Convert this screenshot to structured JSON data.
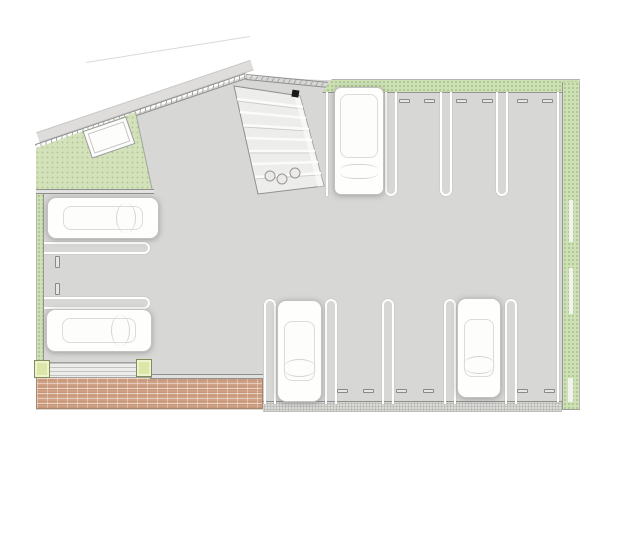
{
  "document": {
    "kind": "architectural site plan",
    "view": "top-down parking lot layout drawing",
    "visible_text": "none"
  },
  "legend_colors": {
    "pavement": "#d7d7d5",
    "landscaping_green": "#cde0b6",
    "brick_paving": "#cfa083",
    "gravel_edge": "#d9d9d6",
    "stall_marking": "#ffffff",
    "boundary_line": "#8f8f8f",
    "planter_post": "#dce6a8"
  },
  "parking_rows": [
    {
      "id": "top-row",
      "orientation": "vertical stalls entered from the south aisle",
      "stalls": 4,
      "occupied": 1,
      "wheel_stop_pairs": 3,
      "marking_style": "white hairpin loops rounded toward aisle"
    },
    {
      "id": "left-column",
      "orientation": "horizontal stalls entered from the east aisle",
      "stalls": 3,
      "occupied": 2,
      "wheel_stop_pairs": 1,
      "marking_style": "white hairpin loops rounded toward aisle"
    },
    {
      "id": "bottom-row",
      "orientation": "vertical stalls entered from the north aisle",
      "stalls": 5,
      "occupied": 2,
      "wheel_stop_pairs": 3,
      "marking_style": "white hairpin loops rounded toward aisle"
    }
  ],
  "vehicles": [
    {
      "id": "van-top-row",
      "type": "van",
      "color": "white"
    },
    {
      "id": "car-left-top",
      "type": "car",
      "color": "white"
    },
    {
      "id": "car-left-bottom",
      "type": "car",
      "color": "white"
    },
    {
      "id": "car-bottom-middle",
      "type": "car",
      "color": "white"
    },
    {
      "id": "car-bottom-right",
      "type": "car",
      "color": "white"
    }
  ],
  "site_features": [
    {
      "id": "diagonal-boundary-wall",
      "desc": "hatched double-line boundary wall along the northwest diagonal edge with parallel road band outside"
    },
    {
      "id": "landscape-wedge",
      "desc": "green planted wedge inside the northwest corner"
    },
    {
      "id": "small-shed",
      "desc": "small white flat-roofed structure sitting on the diagonal boundary"
    },
    {
      "id": "outbuilding-structure",
      "desc": "rotated striped enclosure with round containers beside the entrance drive"
    },
    {
      "id": "north-landscape-strip",
      "desc": "dotted planted strip along the north edge of the stalls"
    },
    {
      "id": "east-landscape-strip",
      "desc": "dotted planted strip along the east edge with small white path gaps"
    },
    {
      "id": "west-landscape-strip",
      "desc": "narrow planted strip along the west edge"
    },
    {
      "id": "brick-terrace",
      "desc": "brick-paved terrace across the southwest corner"
    },
    {
      "id": "pergola-fence",
      "desc": "slatted fence band with two square green planter posts above the terrace"
    },
    {
      "id": "gravel-strip",
      "desc": "gravel drainage strip along the south edge of the bottom stalls"
    }
  ]
}
